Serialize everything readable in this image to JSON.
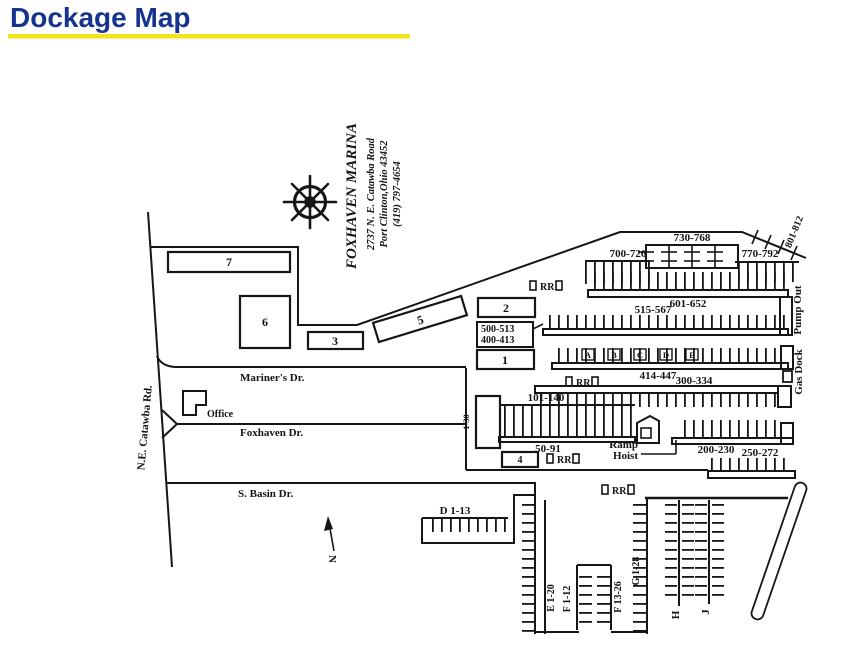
{
  "header": {
    "title": "Dockage Map",
    "underline_color": "#f2e41a",
    "title_color": "#16338f"
  },
  "marina": {
    "name": "FOXHAVEN MARINA",
    "address": "2737 N. E. Catawba Road",
    "city": "Port Clinton,Ohio 43452",
    "phone": "(419) 797-4654"
  },
  "roads": {
    "catawba": "N.E. Catawba Rd.",
    "mariners": "Mariner's Dr.",
    "foxhaven": "Foxhaven Dr.",
    "sbasin": "S. Basin Dr."
  },
  "buildings": {
    "b1": "1",
    "b2": "2",
    "b3": "3",
    "b4": "4",
    "b5": "5",
    "b6": "6",
    "b7": "7",
    "office": "Office"
  },
  "facilities": {
    "pump_out": "Pump Out",
    "gas_dock": "Gas Dock",
    "ramp": "Ramp",
    "hoist": "Hoist",
    "restroom": "RR",
    "north": "N"
  },
  "docks": {
    "d730": "730-768",
    "d700": "700-726",
    "d770": "770-792",
    "d801": "801-812",
    "d601": "601-652",
    "d515": "515-567",
    "d500": "500-513",
    "d400": "400-413",
    "d414": "414-447",
    "d300": "300-334",
    "d101": "101-140",
    "d130": "1-30",
    "d50": "50-91",
    "d200": "200-230",
    "d250": "250-272",
    "dD": "D 1-13",
    "dE": "E 1-20",
    "dF1": "F 1-12",
    "dF13": "F 13-26",
    "dG": "G 1-28",
    "dH": "H",
    "dJ": "J"
  },
  "piers": {
    "a": "A",
    "b": "B",
    "c": "C",
    "d": "D",
    "e": "E"
  }
}
